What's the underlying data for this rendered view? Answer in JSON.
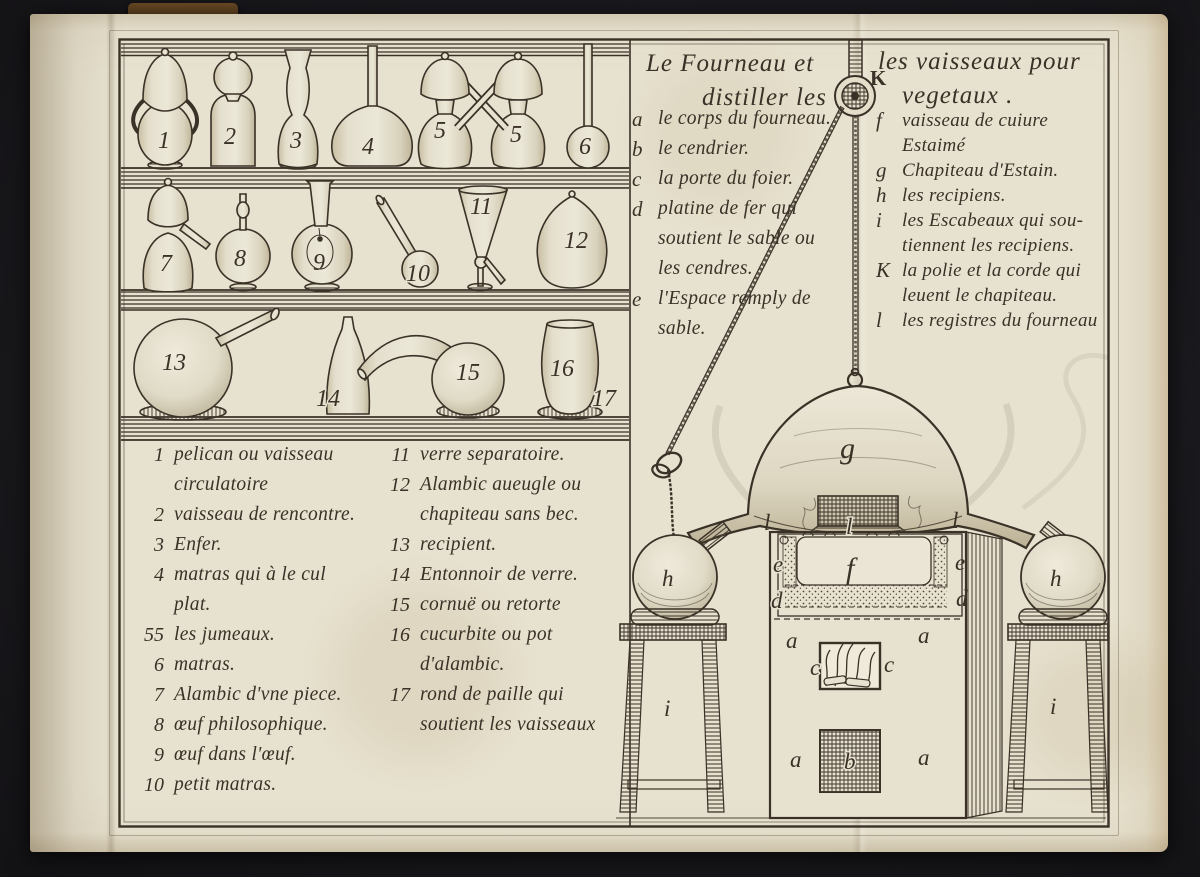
{
  "plate": {
    "title": {
      "left1": "Le Fourneau et",
      "right1": "les vaisseaux pour",
      "left2": "distiller les",
      "right2": "vegetaux .",
      "pulley_label": "K"
    },
    "letter_legend_left": [
      {
        "k": "a",
        "lines": [
          "le corps du fourneau."
        ]
      },
      {
        "k": "b",
        "lines": [
          "le cendrier."
        ]
      },
      {
        "k": "c",
        "lines": [
          "la porte du foier."
        ]
      },
      {
        "k": "d",
        "lines": [
          "platine de fer qui",
          "soutient le sable ou",
          "les cendres."
        ]
      },
      {
        "k": "e",
        "lines": [
          "l'Espace remply de",
          "sable."
        ]
      }
    ],
    "letter_legend_right": [
      {
        "k": "f",
        "lines": [
          "vaisseau de cuiure",
          "Estaimé"
        ]
      },
      {
        "k": "g",
        "lines": [
          "Chapiteau d'Estain."
        ]
      },
      {
        "k": "h",
        "lines": [
          "les recipiens."
        ]
      },
      {
        "k": "i",
        "lines": [
          "les Escabeaux qui sou-",
          "tiennent les recipiens."
        ]
      },
      {
        "k": "K",
        "lines": [
          "la polie et la corde qui",
          "leuent le chapiteau."
        ]
      },
      {
        "k": "l",
        "lines": [
          "les registres du fourneau"
        ]
      }
    ],
    "number_legend_col1": [
      {
        "k": "1",
        "lines": [
          "pelican ou vaisseau",
          "circulatoire"
        ]
      },
      {
        "k": "2",
        "lines": [
          "vaisseau de rencontre."
        ]
      },
      {
        "k": "3",
        "lines": [
          "Enfer."
        ]
      },
      {
        "k": "4",
        "lines": [
          "matras qui à le cul",
          "plat."
        ]
      },
      {
        "k": "55",
        "lines": [
          "les jumeaux."
        ]
      },
      {
        "k": "6",
        "lines": [
          "matras."
        ]
      },
      {
        "k": "7",
        "lines": [
          "Alambic d'vne piece."
        ]
      },
      {
        "k": "8",
        "lines": [
          "œuf philosophique."
        ]
      },
      {
        "k": "9",
        "lines": [
          "œuf dans l'œuf."
        ]
      },
      {
        "k": "10",
        "lines": [
          "petit matras."
        ]
      }
    ],
    "number_legend_col2": [
      {
        "k": "11",
        "lines": [
          "verre separatoire."
        ]
      },
      {
        "k": "12",
        "lines": [
          "Alambic aueugle ou",
          "chapiteau sans bec."
        ]
      },
      {
        "k": "13",
        "lines": [
          "recipient."
        ]
      },
      {
        "k": "14",
        "lines": [
          "Entonnoir de verre."
        ]
      },
      {
        "k": "15",
        "lines": [
          "cornuë ou retorte"
        ]
      },
      {
        "k": "16",
        "lines": [
          "cucurbite ou pot",
          "d'alambic."
        ]
      },
      {
        "k": "17",
        "lines": [
          "rond de paille qui",
          "soutient les vaisseaux"
        ]
      }
    ],
    "shelf_numbers": {
      "r1": [
        "1",
        "2",
        "3",
        "4",
        "5",
        "5",
        "6"
      ],
      "r2": [
        "7",
        "8",
        "9",
        "10",
        "11",
        "12"
      ],
      "r3": [
        "13",
        "14",
        "15",
        "16",
        "17"
      ]
    },
    "furnace_labels": {
      "g": "g",
      "f": "f",
      "b": "b",
      "c_left": "c",
      "c_right": "c",
      "e_left": "e",
      "e_right": "e",
      "d_left": "d",
      "d_right": "d",
      "l_left": "l",
      "l_center": "l",
      "l_right": "l",
      "a_top_left": "a",
      "a_top_right": "a",
      "a_bottom_left": "a",
      "a_bottom_right": "a",
      "h_left": "h",
      "h_right": "h",
      "i_left": "i",
      "i_right": "i"
    },
    "colors": {
      "ink": "#3a3127",
      "paper": "#e7e2d0"
    }
  }
}
